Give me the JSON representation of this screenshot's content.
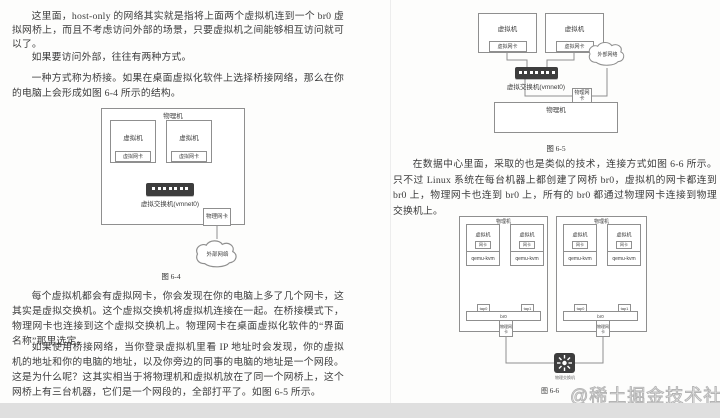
{
  "doc": {
    "left": {
      "p1": "这里面，host-only 的网络其实就是指将上面两个虚拟机连到一个 br0 虚拟网桥上，而且不考虑访问外部的场景，只要虚拟机之间能够相互访问就可以了。",
      "p2": "如果要访问外部，往往有两种方式。",
      "p3": "一种方式称为桥接。如果在桌面虚拟化软件上选择桥接网络，那么在你的电脑上会形成如图 6-4 所示的结构。",
      "p4": "每个虚拟机都会有虚拟网卡，你会发现在你的电脑上多了几个网卡，这其实是虚拟交换机。这个虚拟交换机将虚拟机连接在一起。在桥接模式下，物理网卡也连接到这个虚拟交换机上。物理网卡在桌面虚拟化软件的“界面名称”那里选定。",
      "p5": "如果使用桥接网络，当你登录虚拟机里看 IP 地址时会发现，你的虚拟机的地址和你的电脑的地址，以及你旁边的同事的电脑的地址是一个网段。这是为什么呢？这其实相当于将物理机和虚拟机放在了同一个网桥上，这个网桥上有三台机器，它们是一个网段的，全部打平了。如图 6-5 所示。"
    },
    "right": {
      "p1": "在数据中心里面，采取的也是类似的技术，连接方式如图 6-6 所示。只不过 Linux 系统在每台机器上都创建了网桥 br0，虚拟机的网卡都连到 br0 上，物理网卡也连到 br0 上，所有的 br0 都通过物理网卡连接到物理交换机上。"
    },
    "watermark": "@稀土掘金技术社区"
  },
  "fig64": {
    "caption": "图 6-4",
    "host": "物理机",
    "vm": "虚拟机",
    "vnic": "虚拟网卡",
    "switch": "虚拟交换机(vmnet0)",
    "pnic": "物理网卡",
    "cloud": "外部网络"
  },
  "fig65": {
    "caption": "图 6-5",
    "host": "物理机",
    "vm": "虚拟机",
    "vnic": "虚拟网卡",
    "switch": "虚拟交换机(vmnet0)",
    "pnic": "物理网卡",
    "cloud": "外部网络"
  },
  "fig66": {
    "caption": "图 6-6",
    "host": "物理机",
    "vm": "虚拟机",
    "nic": "网卡",
    "hypervisor": "qemu-kvm",
    "tap0": "tap0",
    "tap1": "tap1",
    "bridge": "br0",
    "pnic": "物理网卡",
    "switch": "物理交换机"
  }
}
